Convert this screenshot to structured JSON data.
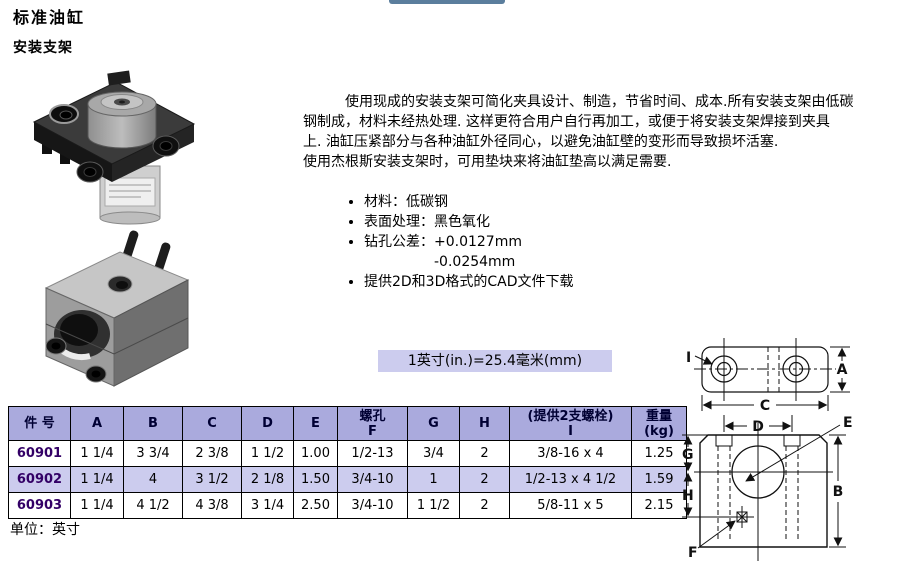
{
  "page": {
    "title": "标准油缸",
    "subtitle": "安装支架"
  },
  "intro": {
    "lines": [
      "使用现成的安装支架可简化夹具设计、制造，节省时间、成本.所有安装支架由低碳",
      "钢制成，材料未经热处理. 这样更符合用户自行再加工，或便于将安装支架焊接到夹具",
      "上. 油缸压紧部分与各种油缸外径同心，以避免油缸壁的变形而导致损坏活塞.",
      "使用杰根斯安装支架时，可用垫块来将油缸垫高以满足需要."
    ]
  },
  "bullets": {
    "items": [
      "材料：低碳钢",
      "表面处理：黑色氧化",
      "钻孔公差：+0.0127mm",
      "提供2D和3D格式的CAD文件下载"
    ],
    "tolerance_second_line": "-0.0254mm"
  },
  "conversion": {
    "text": "1英寸(in.)=25.4毫米(mm)"
  },
  "table": {
    "headers": {
      "part": "件 号",
      "a": "A",
      "b": "B",
      "c": "C",
      "d": "D",
      "e": "E",
      "f": "螺孔\nF",
      "g": "G",
      "h": "H",
      "i": "(提供2支螺栓)\nI",
      "weight": "重量\n(kg)"
    },
    "rows": [
      {
        "part": "60901",
        "a": "1 1/4",
        "b": "3 3/4",
        "c": "2 3/8",
        "d": "1 1/2",
        "e": "1.00",
        "f": "1/2-13",
        "g": "3/4",
        "h": "2",
        "i": "3/8-16 x 4",
        "weight": "1.25"
      },
      {
        "part": "60902",
        "a": "1 1/4",
        "b": "4",
        "c": "3 1/2",
        "d": "2 1/8",
        "e": "1.50",
        "f": "3/4-10",
        "g": "1",
        "h": "2",
        "i": "1/2-13 x 4 1/2",
        "weight": "1.59"
      },
      {
        "part": "60903",
        "a": "1 1/4",
        "b": "4 1/2",
        "c": "4 3/8",
        "d": "3 1/4",
        "e": "2.50",
        "f": "3/4-10",
        "g": "1 1/2",
        "h": "2",
        "i": "5/8-11 x 5",
        "weight": "2.15"
      }
    ],
    "unit_note": "单位：英寸"
  },
  "diagram": {
    "labels": {
      "i": "I",
      "a": "A",
      "c": "C",
      "d": "D",
      "e": "E",
      "g": "G",
      "h": "H",
      "b": "B",
      "f": "F"
    }
  },
  "images": {
    "photo1": "flange-mount-bracket-with-cylinder-photo",
    "photo2": "block-mount-bracket-photo"
  },
  "colors": {
    "header_bg": "#aaaadd",
    "alt_row_bg": "#ccccee",
    "part_number": "#330066",
    "banner_bg": "#ccccee",
    "top_bar": "#5b7e9d"
  }
}
